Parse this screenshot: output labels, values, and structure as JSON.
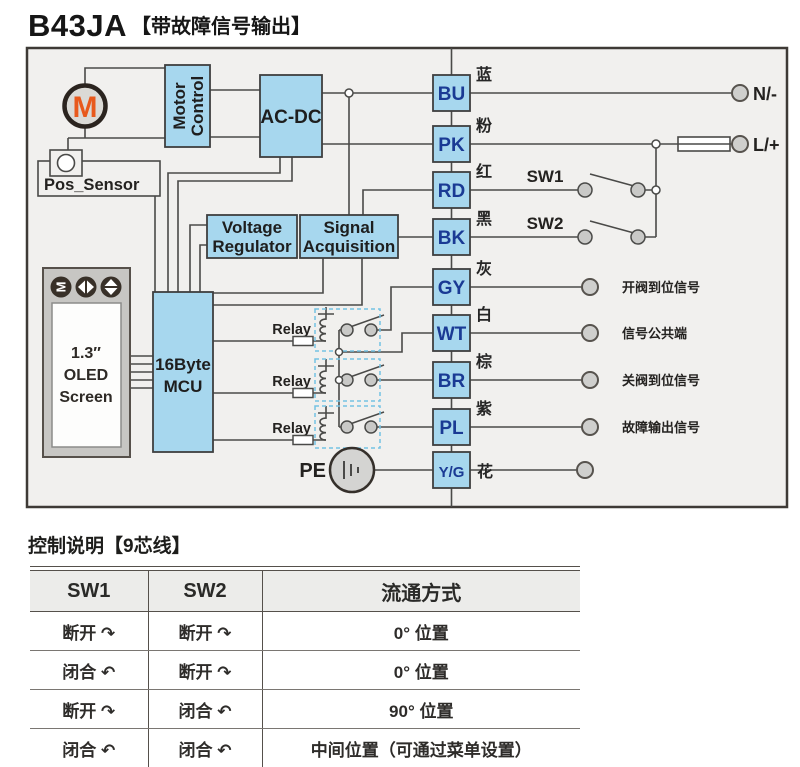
{
  "title": {
    "model": "B43JA",
    "tag": "【带故障信号输出】"
  },
  "diagram": {
    "motor": {
      "label": "M"
    },
    "motor_control": {
      "line1": "Motor",
      "line2": "Control"
    },
    "acdc": {
      "label": "AC-DC"
    },
    "pos_sensor": {
      "label": "Pos_Sensor"
    },
    "voltage_regulator": {
      "line1": "Voltage",
      "line2": "Regulator"
    },
    "signal_acquisition": {
      "line1": "Signal",
      "line2": "Acquisition"
    },
    "mcu": {
      "line1": "16Byte",
      "line2": "MCU"
    },
    "oled": {
      "button_m": "M",
      "line1": "1.3″",
      "line2": "OLED",
      "line3": "Screen"
    },
    "relays": {
      "label1": "Relay",
      "label2": "Relay",
      "label3": "Relay"
    },
    "pe": {
      "label": "PE"
    },
    "terminals": [
      {
        "code": "BU",
        "cn": "蓝"
      },
      {
        "code": "PK",
        "cn": "粉"
      },
      {
        "code": "RD",
        "cn": "红"
      },
      {
        "code": "BK",
        "cn": "黑"
      },
      {
        "code": "GY",
        "cn": "灰"
      },
      {
        "code": "WT",
        "cn": "白"
      },
      {
        "code": "BR",
        "cn": "棕"
      },
      {
        "code": "PL",
        "cn": "紫"
      },
      {
        "code": "Y/G",
        "cn": "花"
      }
    ],
    "switches": {
      "sw1": "SW1",
      "sw2": "SW2"
    },
    "power": {
      "neutral": "N/-",
      "live": "L/+"
    },
    "signals": {
      "open_ok": "开阀到位信号",
      "common": "信号公共端",
      "close_ok": "关阀到位信号",
      "fault": "故障输出信号"
    }
  },
  "control_table": {
    "heading": "控制说明【9芯线】",
    "columns": [
      "SW1",
      "SW2",
      "流通方式"
    ],
    "rows": [
      [
        "断开 ↷",
        "断开 ↷",
        "0° 位置"
      ],
      [
        "闭合 ↶",
        "断开 ↷",
        "0° 位置"
      ],
      [
        "断开 ↷",
        "闭合 ↶",
        "90° 位置"
      ],
      [
        "闭合 ↶",
        "闭合 ↶",
        "中间位置（可通过菜单设置）"
      ]
    ]
  },
  "colors": {
    "box_fill": "#a7d7ee",
    "wire": "#4a4a48",
    "terminal_text": "#1a3a94",
    "motor_m": "#e8591c"
  }
}
